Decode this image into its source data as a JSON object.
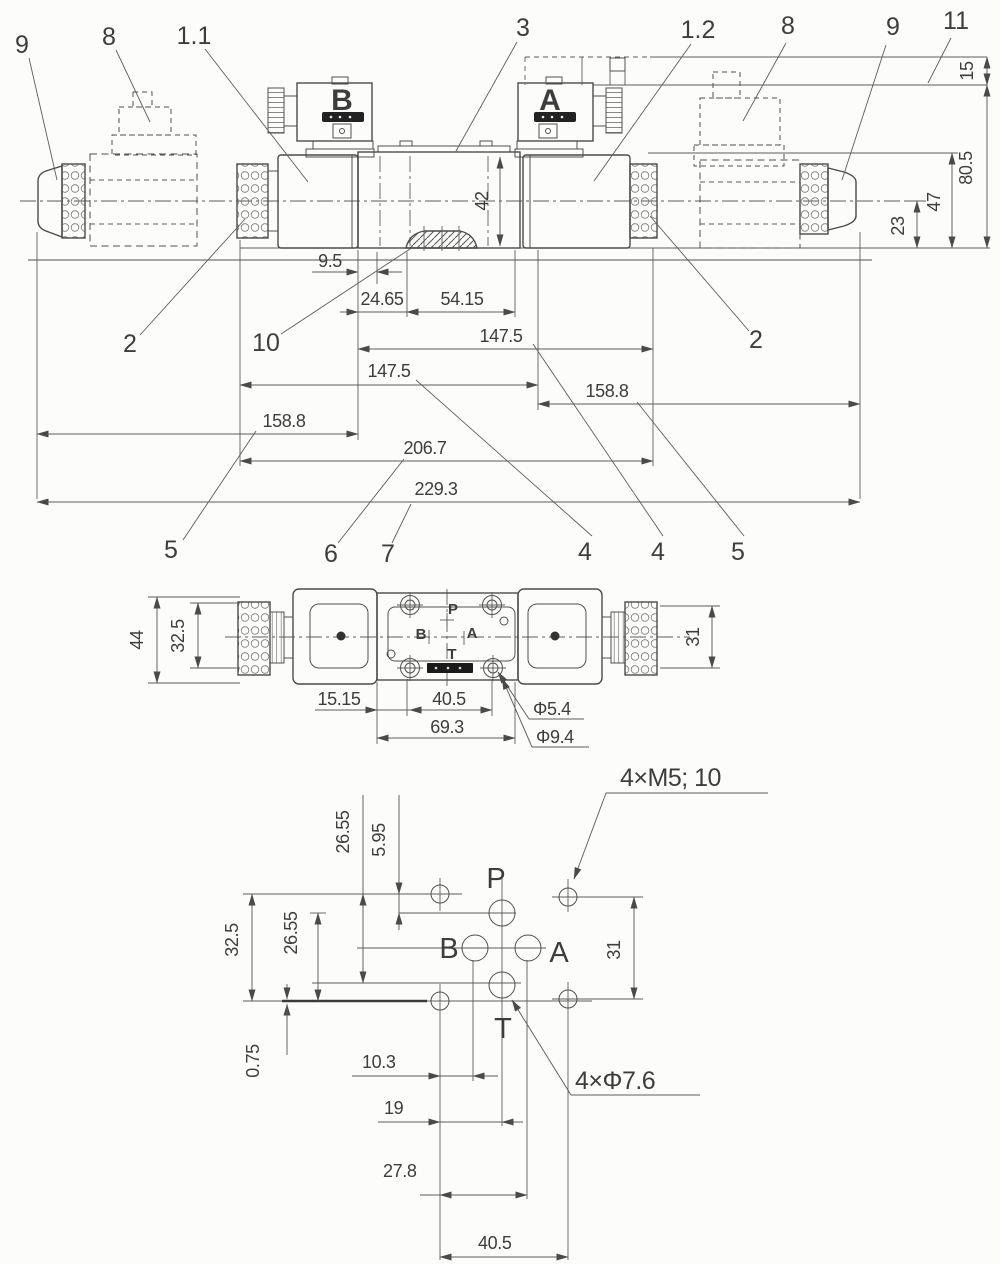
{
  "front": {
    "solenoid_b_label": "B",
    "solenoid_a_label": "A",
    "callouts": {
      "c9l": "9",
      "c8l": "8",
      "c1_1": "1.1",
      "c3": "3",
      "c1_2": "1.2",
      "c8r": "8",
      "c9r": "9",
      "c11": "11",
      "c2l": "2",
      "c10": "10",
      "c2r": "2",
      "c5l": "5",
      "c6": "6",
      "c7": "7",
      "c4l": "4",
      "c4r": "4",
      "c5r": "5"
    },
    "dims": {
      "w9_5": "9.5",
      "w24_65": "24.65",
      "w54_15": "54.15",
      "w147_5_1": "147.5",
      "w147_5_2": "147.5",
      "w158_8_1": "158.8",
      "w158_8_2": "158.8",
      "w206_7": "206.7",
      "w229_3": "229.3",
      "h42": "42",
      "h15": "15",
      "h80_5": "80.5",
      "h47": "47",
      "h23": "23"
    }
  },
  "top": {
    "dims": {
      "h44": "44",
      "h32_5": "32.5",
      "h31": "31",
      "w15_15": "15.15",
      "w40_5": "40.5",
      "w69_3": "69.3",
      "dia5_4": "Φ5.4",
      "dia9_4": "Φ9.4"
    },
    "ports": {
      "p": "P",
      "a": "A",
      "b": "B",
      "t": "T"
    }
  },
  "bottom": {
    "dims": {
      "v26_55_t": "26.55",
      "v5_95": "5.95",
      "v32_5": "32.5",
      "v26_55_l": "26.55",
      "v0_75": "0.75",
      "w10_3": "10.3",
      "w19": "19",
      "w27_8": "27.8",
      "w40_5": "40.5",
      "v31": "31"
    },
    "notes": {
      "m5": "4×M5; 10",
      "phi7_6": "4×Φ7.6"
    },
    "ports": {
      "p": "P",
      "a": "A",
      "b": "B",
      "t": "T"
    }
  }
}
